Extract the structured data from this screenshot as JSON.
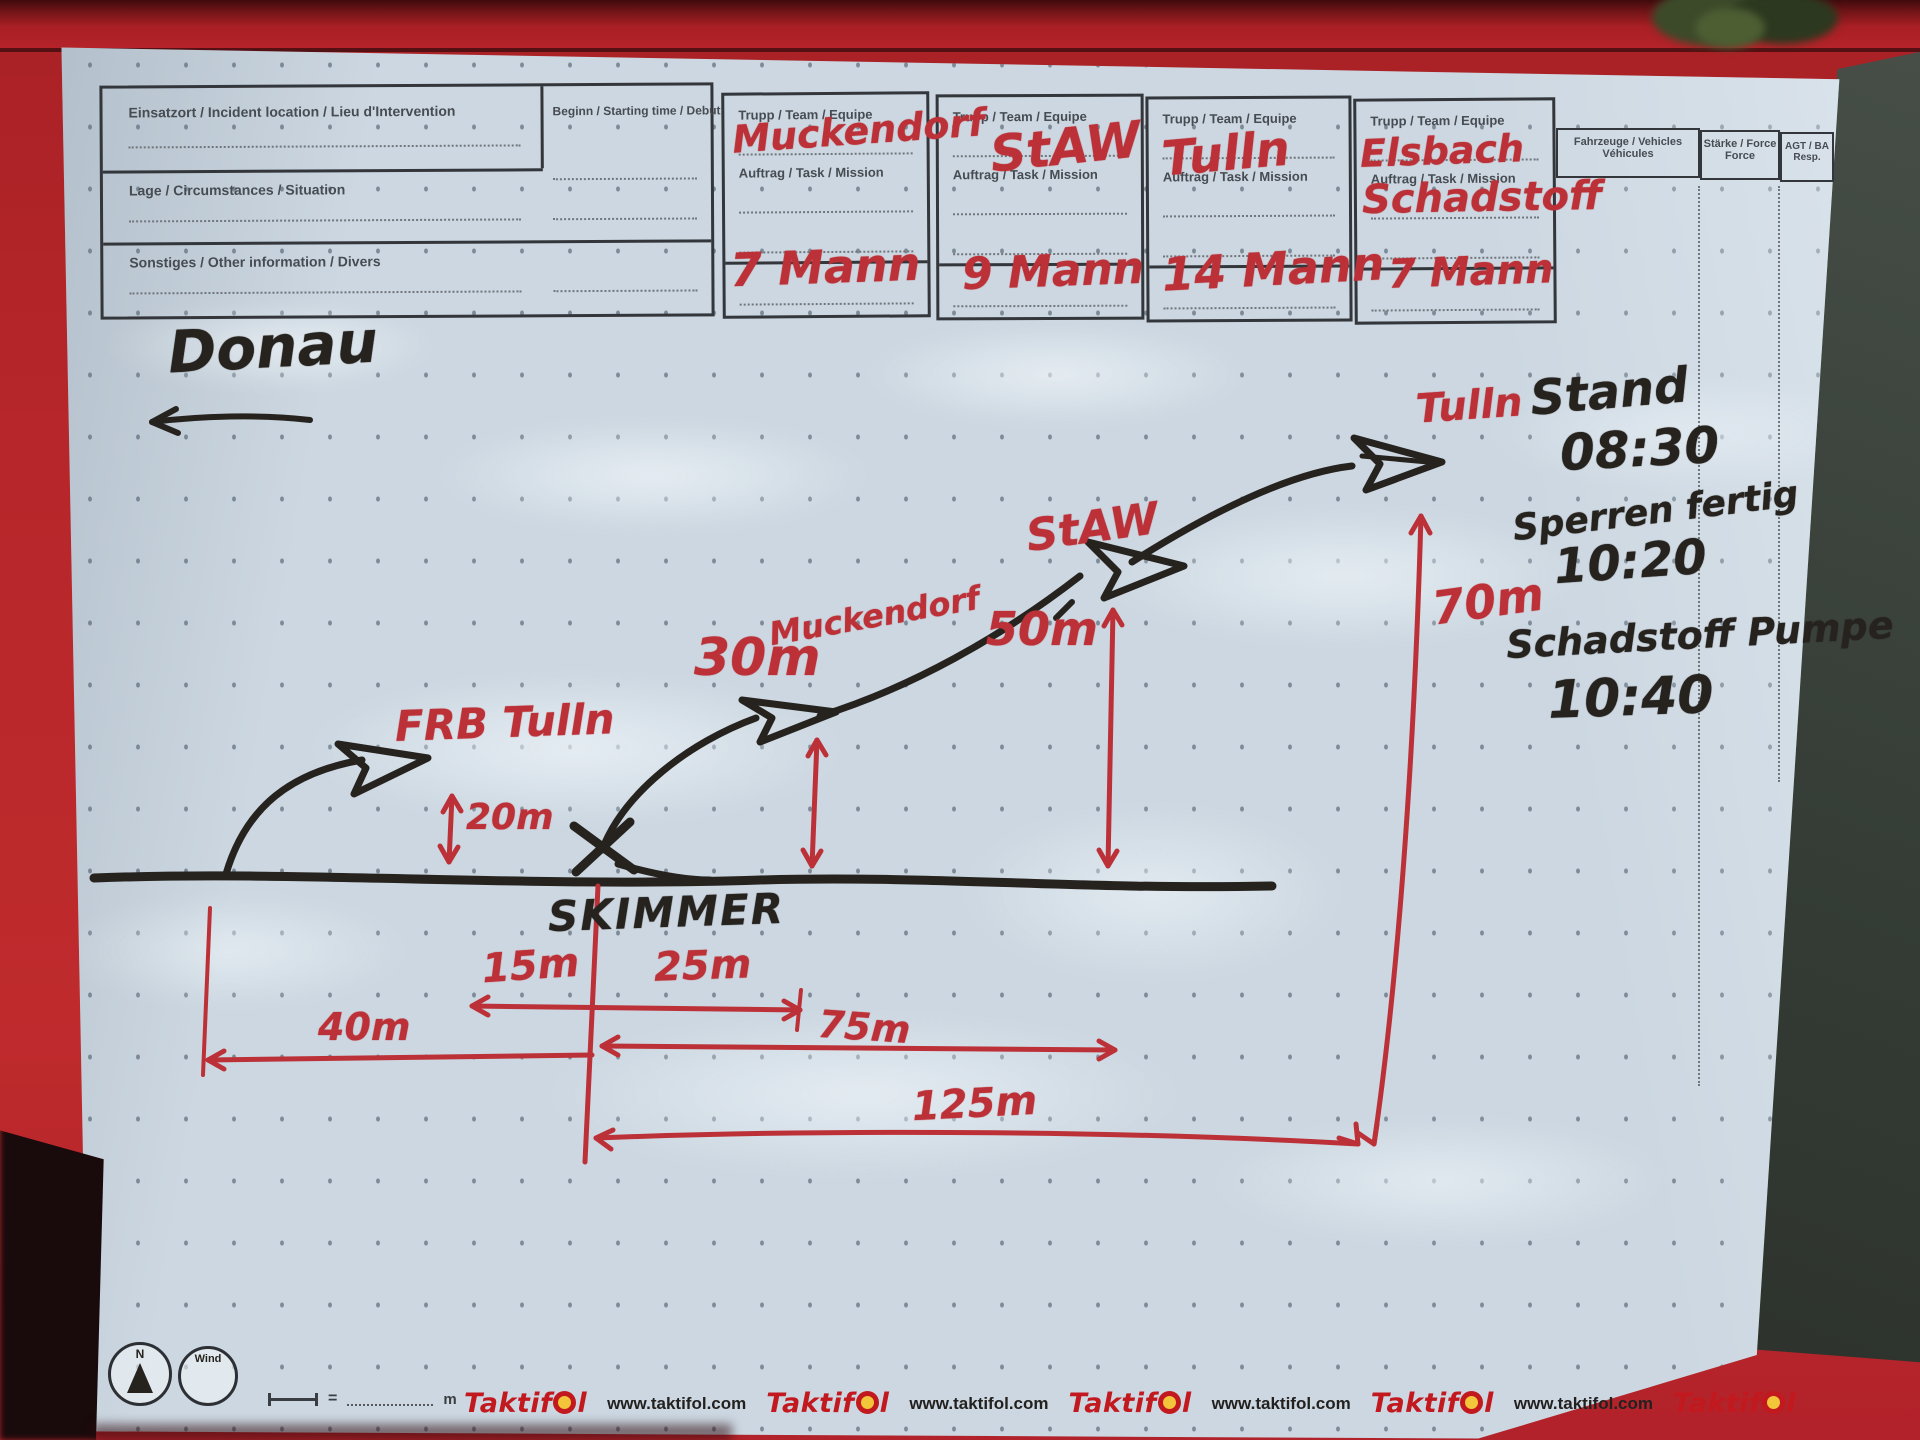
{
  "colors": {
    "marker_red": "#bc3137",
    "marker_black": "#26231f",
    "truck_red": "#b6262a",
    "foil": "#ccd7e1",
    "brand_red": "#c2191f"
  },
  "form": {
    "einsatzort_label": "Einsatzort / Incident location / Lieu d'Intervention",
    "beginn_label": "Beginn / Starting time / Debut",
    "lage_label": "Lage / Circumstances / Situation",
    "sonstiges_label": "Sonstiges / Other information / Divers",
    "trupp_label": "Trupp / Team / Equipe",
    "auftrag_label": "Auftrag / Task / Mission",
    "fahrzeuge_label_1": "Fahrzeuge / Vehicles",
    "fahrzeuge_label_2": "Véhicules",
    "staerke_label_1": "Stärke / Force",
    "staerke_label_2": "Force",
    "agt_label_1": "AGT / BA",
    "agt_label_2": "Resp."
  },
  "teams": [
    {
      "name": "Muckendorf",
      "task": "",
      "strength": "7 Mann"
    },
    {
      "name": "StAW",
      "task": "",
      "strength": "9 Mann"
    },
    {
      "name": "Tulln",
      "task": "",
      "strength": "14 Mann"
    },
    {
      "name": "Elsbach",
      "task": "Schadstoff",
      "strength": "7 Mann"
    }
  ],
  "sketch": {
    "river_label": "Donau",
    "skimmer_label": "SKIMMER",
    "barrier_labels": [
      "FRB Tulln",
      "Muckendorf",
      "StAW",
      "Tulln"
    ],
    "heights": [
      "20m",
      "30m",
      "50m",
      "70m"
    ],
    "distances": [
      "15m",
      "25m",
      "40m",
      "75m",
      "125m"
    ]
  },
  "notes": {
    "line1": "Stand",
    "time1": "08:30",
    "line2": "Sperren fertig",
    "time2": "10:20",
    "line3": "Schadstoff Pumpe",
    "time3": "10:40"
  },
  "footer": {
    "north": "N",
    "wind": "Wind",
    "scale_equals": "=",
    "scale_unit": "m",
    "brand": "Taktifol",
    "brand_pre": "Taktif",
    "brand_post": "l",
    "url": "www.taktifol.com"
  }
}
